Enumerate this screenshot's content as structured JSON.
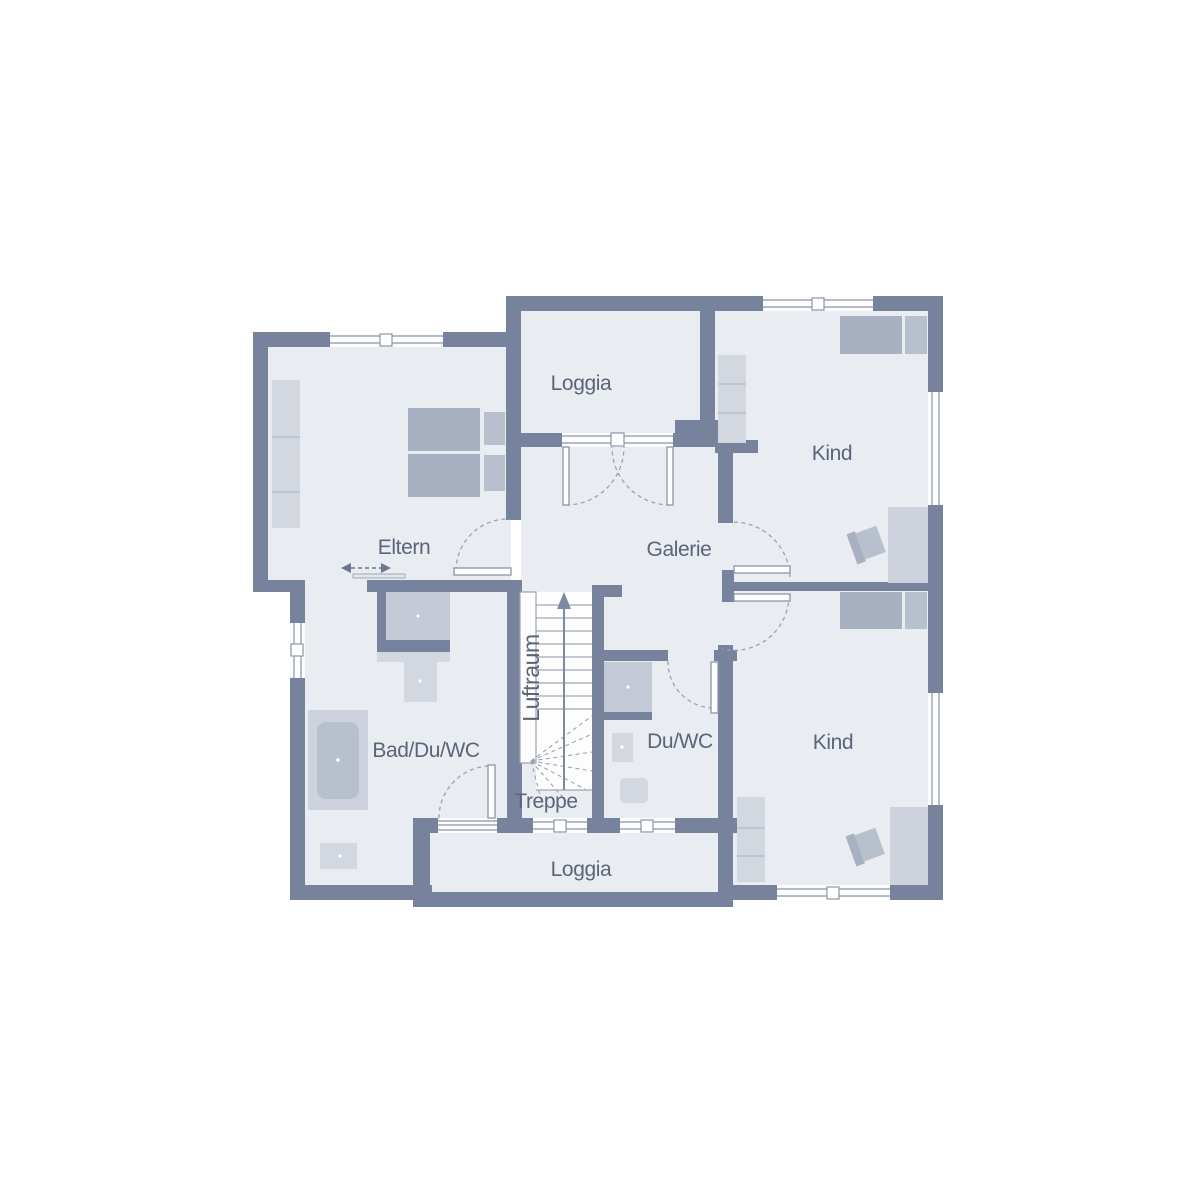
{
  "plan": {
    "type": "residential-floor-plan",
    "rooms": {
      "eltern": {
        "label": "Eltern"
      },
      "loggia_top": {
        "label": "Loggia"
      },
      "kind_top": {
        "label": "Kind"
      },
      "galerie": {
        "label": "Galerie"
      },
      "bad_du_wc": {
        "label": "Bad/Du/WC"
      },
      "du_wc": {
        "label": "Du/WC"
      },
      "kind_bottom": {
        "label": "Kind"
      },
      "loggia_bottom": {
        "label": "Loggia"
      },
      "treppe": {
        "label": "Treppe"
      },
      "luftraum": {
        "label": "Luftraum"
      }
    },
    "fixtures": [
      "double-bed",
      "single-bed",
      "wardrobe",
      "desk",
      "chair",
      "bathtub",
      "shower",
      "washbasin",
      "toilet",
      "stairs",
      "stair-direction-arrow",
      "sliding-door",
      "swing-door",
      "window"
    ],
    "palette": {
      "wall": "#77839c",
      "floor": "#e9ecf1",
      "background": "#ffffff",
      "furniture_dark": "#a8b1c2",
      "furniture_mid": "#b9c0cd",
      "furniture_light": "#d3d7e0",
      "fixture": "#cdd2dc",
      "line": "#8b94a8",
      "text": "#5a6578"
    }
  }
}
